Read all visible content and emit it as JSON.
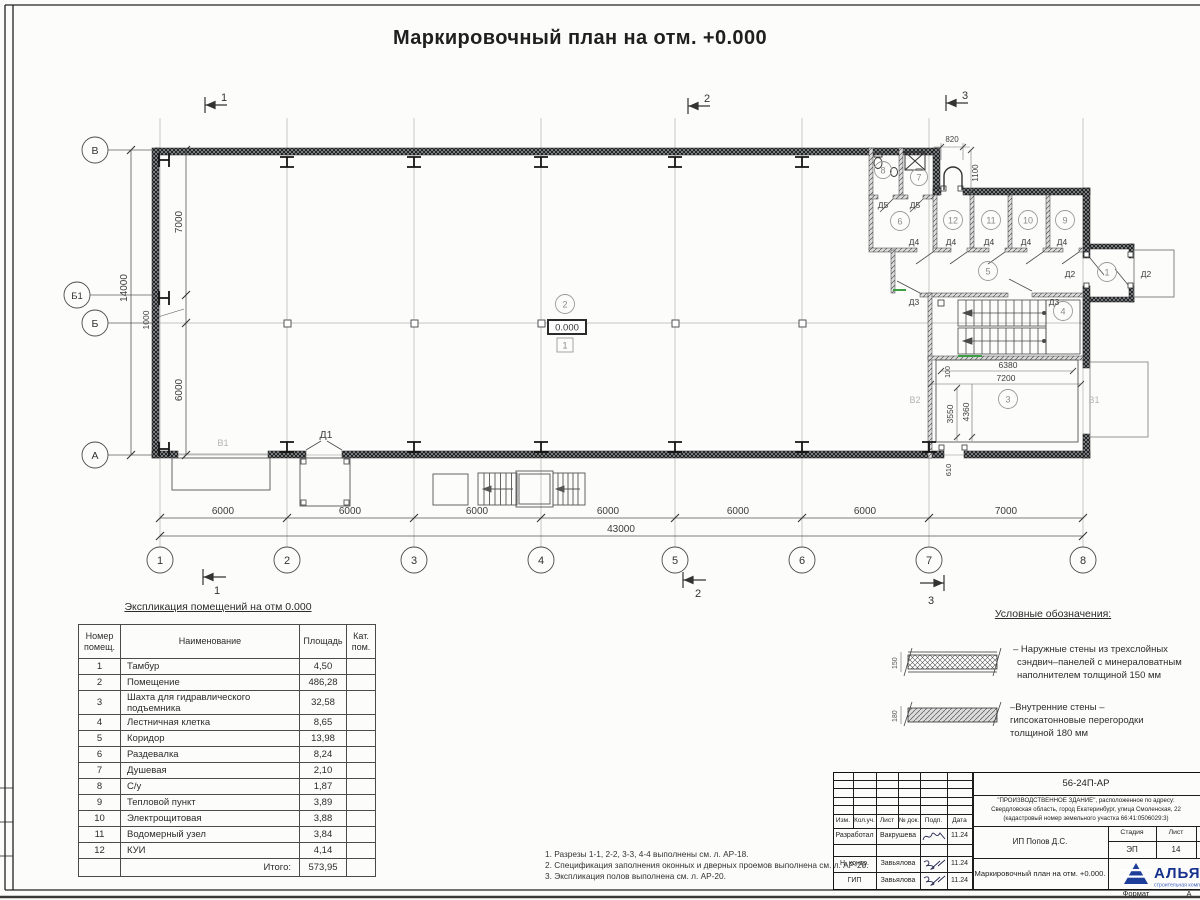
{
  "title": "Маркировочный план на отм. +0.000",
  "plan": {
    "grid_cols": [
      "1",
      "2",
      "3",
      "4",
      "5",
      "6",
      "7",
      "8"
    ],
    "grid_rows": {
      "v": "В",
      "b1": "Б1",
      "b": "Б",
      "a": "А"
    },
    "dims_bottom": [
      "6000",
      "6000",
      "6000",
      "6000",
      "6000",
      "6000",
      "7000"
    ],
    "dim_total": "43000",
    "dims_left": {
      "d7000": "7000",
      "d1000": "1000",
      "d6000": "6000",
      "total": "14000"
    },
    "entry_dims": {
      "w": "820",
      "h": "1100"
    },
    "shaft_dims": {
      "w_in": "6380",
      "w_out": "7200",
      "h1": "3550",
      "h2": "4360",
      "off": "100",
      "gate": "610"
    },
    "section_marks": [
      "1",
      "2",
      "3"
    ],
    "level_mark": "0.000",
    "floor_type": "1",
    "room_numbers": [
      "1",
      "2",
      "3",
      "4",
      "5",
      "6",
      "7",
      "8",
      "9",
      "10",
      "11",
      "12"
    ],
    "door_labels": {
      "d1": "Д1",
      "d2": "Д2",
      "d3": "Д3",
      "d4": "Д4",
      "d5": "Д5"
    },
    "gate_labels": {
      "v1": "В1",
      "v2": "В2"
    }
  },
  "table": {
    "title": "Экспликация помещений на отм 0.000",
    "headers": {
      "num": "Номер помещ.",
      "name": "Наименование",
      "area": "Площадь",
      "cat": "Кат. пом."
    },
    "rows": [
      {
        "num": "1",
        "name": "Тамбур",
        "area": "4,50"
      },
      {
        "num": "2",
        "name": "Помещение",
        "area": "486,28"
      },
      {
        "num": "3",
        "name": "Шахта для гидравлического подъемника",
        "area": "32,58"
      },
      {
        "num": "4",
        "name": "Лестничная клетка",
        "area": "8,65"
      },
      {
        "num": "5",
        "name": "Коридор",
        "area": "13,98"
      },
      {
        "num": "6",
        "name": "Раздевалка",
        "area": "8,24"
      },
      {
        "num": "7",
        "name": "Душевая",
        "area": "2,10"
      },
      {
        "num": "8",
        "name": "С/у",
        "area": "1,87"
      },
      {
        "num": "9",
        "name": "Тепловой пункт",
        "area": "3,89"
      },
      {
        "num": "10",
        "name": "Электрощитовая",
        "area": "3,88"
      },
      {
        "num": "11",
        "name": "Водомерный узел",
        "area": "3,84"
      },
      {
        "num": "12",
        "name": "КУИ",
        "area": "4,14"
      }
    ],
    "total_label": "Итого:",
    "total": "573,95"
  },
  "legend": {
    "title": "Условные обозначения:",
    "item1": {
      "dim": "150",
      "line1": "– Наружные стены из трехслойных",
      "line2": "сэндвич–панелей с минераловатным",
      "line3": "наполнителем толщиной 150 мм"
    },
    "item2": {
      "dim": "180",
      "line1": "–Внутренние стены –",
      "line2": "гипсокатонновые перегородки",
      "line3": "толщиной 180 мм"
    }
  },
  "notes": [
    "1. Разрезы 1-1, 2-2, 3-3, 4-4 выполнены см. л. АР-18.",
    "2. Спецификация заполнения оконных и дверных проемов выполнена см. л. АР-20.",
    "3. Экспликация полов выполнена см. л. АР-20."
  ],
  "stamp": {
    "doc_number": "56-24П-АР",
    "address1": "\"ПРОИЗВОДСТВЕННОЕ ЗДАНИЕ\", расположенное по адресу:",
    "address2": "Свердловская область, город Екатеринбург, улица Смоленская, 22",
    "address3": "(кадастровый номер земельного участка 66:41:0506029:3)",
    "cols": {
      "izm": "Изм.",
      "kol": "Кол.уч.",
      "list": "Лист",
      "doc": "№ док.",
      "podp": "Подп.",
      "data": "Дата"
    },
    "rows": [
      {
        "role": "Разработал",
        "name": "Вакрушева",
        "date": "11.24"
      },
      {
        "role": "Н. контр.",
        "name": "Завьялова",
        "date": "11.24"
      },
      {
        "role": "ГИП",
        "name": "Завьялова",
        "date": "11.24"
      }
    ],
    "client": "ИП Попов Д.С.",
    "sheet_title": "Маркировочный план на отм. +0.000.",
    "stage_label": "Стадия",
    "sheet_label": "Лист",
    "sheets_label": "Листов",
    "stage": "ЭП",
    "sheet": "14",
    "sheets": "2",
    "logo": {
      "name": "АЛЬЯНС",
      "tagline": "строительная компания"
    },
    "format_label": "Формат",
    "format_value": "А"
  }
}
